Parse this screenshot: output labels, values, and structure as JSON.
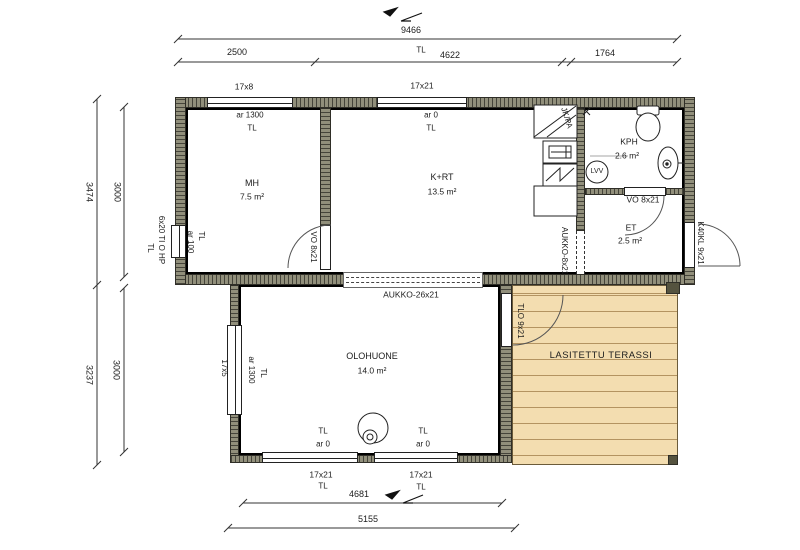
{
  "dimensions": {
    "top_total": "9466",
    "top_left": "2500",
    "top_mid_tl": "TL",
    "top_mid": "4622",
    "top_right": "1764",
    "side_upper_outer": "3474",
    "side_upper_inner": "3000",
    "side_lower_outer": "3237",
    "side_lower_inner": "3000",
    "bottom_inner": "4681",
    "bottom_outer": "5155"
  },
  "windows": {
    "top_small": "17x8",
    "top_large": "17x21",
    "mh_left_type": "6x20 TI O HP",
    "mh_left_tl": "TL",
    "mh_left_ar": "ar 100",
    "mh_left_ar_tl": "TL",
    "living_left": "17x5",
    "living_left_ar": "ar 1300",
    "living_left_tl": "TL",
    "bottom_left": "17x21",
    "bottom_left_tl": "TL",
    "bottom_right": "17x21",
    "bottom_right_tl": "TL"
  },
  "rooms": {
    "mh": {
      "name": "MH",
      "area": "7.5 m²",
      "ar": "ar 1300",
      "tl": "TL"
    },
    "krt": {
      "name": "K+RT",
      "area": "13.5 m²",
      "ar": "ar 0",
      "tl": "TL"
    },
    "kph": {
      "name": "KPH",
      "area": "2.6 m²"
    },
    "et": {
      "name": "ET",
      "area": "2.5 m²"
    },
    "olohuone": {
      "name": "OLOHUONE",
      "area": "14.0 m²",
      "tl_left": "TL",
      "ar_left": "ar 0",
      "tl_right": "TL",
      "ar_right": "ar 0"
    },
    "terassi": {
      "name": "LASITETTU TERASSI"
    }
  },
  "doors": {
    "mh": "VO 8x21",
    "kph": "VO 8x21",
    "entry": "K40KL 9x21",
    "terrace": "TLO 9x21"
  },
  "openings": {
    "living_room": "AUKKO-26x21",
    "kitchen": "AUKKO-8x21"
  },
  "fixtures": {
    "fridge_freezer": "JK/PA",
    "water_heater": "LVV"
  },
  "colors": {
    "wall": "#918f7b",
    "wall_tick": "#45443a",
    "terrace_deck": "#f3ddb0",
    "line": "#222222"
  }
}
